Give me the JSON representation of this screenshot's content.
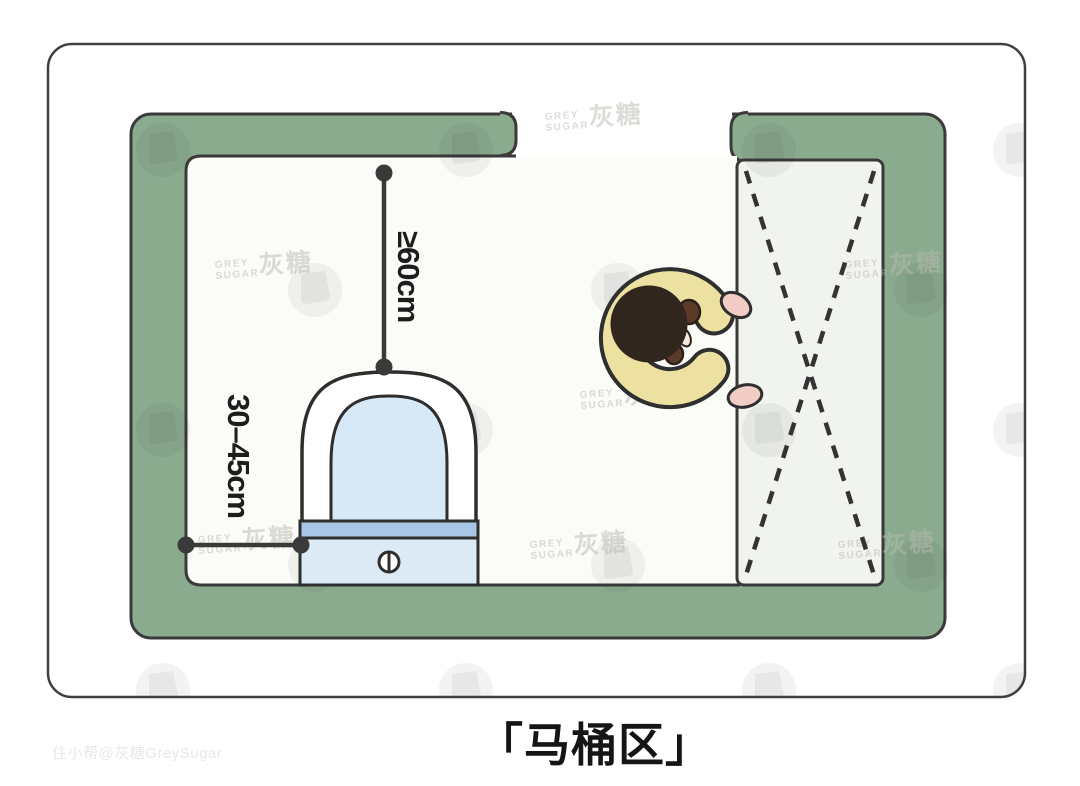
{
  "illustration": {
    "caption": "「马桶区」",
    "measurements": {
      "front_clearance": "≥60cm",
      "side_clearance": "30–45cm"
    },
    "watermark": {
      "brand_line1": "GREY",
      "brand_line2": "SUGAR",
      "brand_cn": "灰糖",
      "credit": "住小帮@灰糖GreySugar"
    },
    "colors": {
      "wall_green": "#8bab8e",
      "floor_white": "#fbfbf8",
      "door_area_grey": "#f1f3ef",
      "outline_dark": "#3a3a3a",
      "bowl_blue": "#d7e8f6",
      "tank_strip_blue": "#a9c6e6",
      "tank_body_blue": "#dceaf5",
      "arm_cream": "#ece1a1",
      "hand_pink": "#f2cdc5",
      "hair_brown": "#31261e"
    }
  }
}
